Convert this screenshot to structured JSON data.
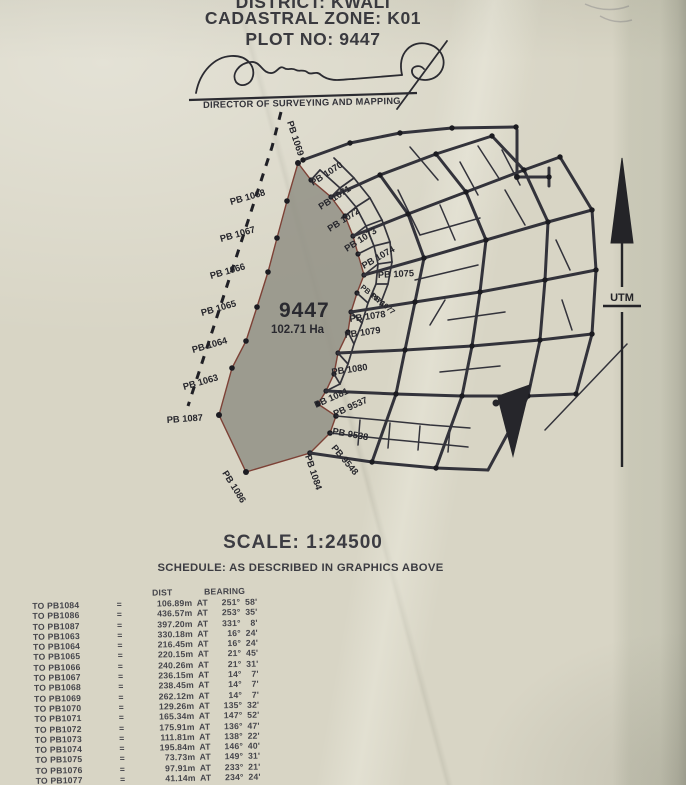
{
  "header": {
    "district": "DISTRICT: KWALI",
    "zone": "CADASTRAL ZONE: K01",
    "plot": "PLOT NO: 9447",
    "signatory": "DIRECTOR OF SURVEYING AND MAPPING"
  },
  "map": {
    "plot_number": "9447",
    "plot_area": "102.71 Ha",
    "north_label": "UTM",
    "labels": [
      {
        "text": "PB 1069"
      },
      {
        "text": "PB 1068"
      },
      {
        "text": "PB 1067"
      },
      {
        "text": "PB 1066"
      },
      {
        "text": "PB 1065"
      },
      {
        "text": "PB 1064"
      },
      {
        "text": "PB 1063"
      },
      {
        "text": "PB 1087"
      },
      {
        "text": "PB 1086"
      },
      {
        "text": "PB 1084"
      },
      {
        "text": "PB 9548"
      },
      {
        "text": "PB 9538"
      },
      {
        "text": "PB 9537"
      },
      {
        "text": "PB 1081"
      },
      {
        "text": "PB 1080"
      },
      {
        "text": "PB 1079"
      },
      {
        "text": "PB 1078"
      },
      {
        "text": "PB 1077"
      },
      {
        "text": "PB 1076"
      },
      {
        "text": "PB 1075"
      },
      {
        "text": "PB 1074"
      },
      {
        "text": "PB 1073"
      },
      {
        "text": "PB 1072"
      },
      {
        "text": "PB 1071"
      },
      {
        "text": "PB 1070"
      }
    ]
  },
  "scale": {
    "text": "SCALE: 1:24500"
  },
  "schedule": {
    "title": "SCHEDULE: AS DESCRIBED IN GRAPHICS ABOVE",
    "col_dist": "DIST",
    "col_bearing": "BEARING",
    "rows": [
      {
        "to": "TO PB1084",
        "eq": "=",
        "dist": "106.89m",
        "at": "AT",
        "bearing": "251° 58'"
      },
      {
        "to": "TO PB1086",
        "eq": "=",
        "dist": "436.57m",
        "at": "AT",
        "bearing": "253° 35'"
      },
      {
        "to": "TO PB1087",
        "eq": "=",
        "dist": "397.20m",
        "at": "AT",
        "bearing": "331° 8'"
      },
      {
        "to": "TO PB1063",
        "eq": "=",
        "dist": "330.18m",
        "at": "AT",
        "bearing": "16° 24'"
      },
      {
        "to": "TO PB1064",
        "eq": "=",
        "dist": "216.45m",
        "at": "AT",
        "bearing": "16° 24'"
      },
      {
        "to": "TO PB1065",
        "eq": "=",
        "dist": "220.15m",
        "at": "AT",
        "bearing": "21° 45'"
      },
      {
        "to": "TO PB1066",
        "eq": "=",
        "dist": "240.26m",
        "at": "AT",
        "bearing": "21° 31'"
      },
      {
        "to": "TO PB1067",
        "eq": "=",
        "dist": "236.15m",
        "at": "AT",
        "bearing": "14° 7'"
      },
      {
        "to": "TO PB1068",
        "eq": "=",
        "dist": "238.45m",
        "at": "AT",
        "bearing": "14° 7'"
      },
      {
        "to": "TO PB1069",
        "eq": "=",
        "dist": "262.12m",
        "at": "AT",
        "bearing": "14° 7'"
      },
      {
        "to": "TO PB1070",
        "eq": "=",
        "dist": "129.26m",
        "at": "AT",
        "bearing": "135° 32'"
      },
      {
        "to": "TO PB1071",
        "eq": "=",
        "dist": "165.34m",
        "at": "AT",
        "bearing": "147° 52'"
      },
      {
        "to": "TO PB1072",
        "eq": "=",
        "dist": "175.91m",
        "at": "AT",
        "bearing": "136° 47'"
      },
      {
        "to": "TO PB1073",
        "eq": "=",
        "dist": "111.81m",
        "at": "AT",
        "bearing": "138° 22'"
      },
      {
        "to": "TO PB1074",
        "eq": "=",
        "dist": "195.84m",
        "at": "AT",
        "bearing": "146° 40'"
      },
      {
        "to": "TO PB1075",
        "eq": "=",
        "dist": "73.73m",
        "at": "AT",
        "bearing": "149° 31'"
      },
      {
        "to": "TO PB1076",
        "eq": "=",
        "dist": "97.91m",
        "at": "AT",
        "bearing": "233° 21'"
      },
      {
        "to": "TO PB1077",
        "eq": "=",
        "dist": "41.14m",
        "at": "AT",
        "bearing": "234° 24'"
      }
    ]
  }
}
